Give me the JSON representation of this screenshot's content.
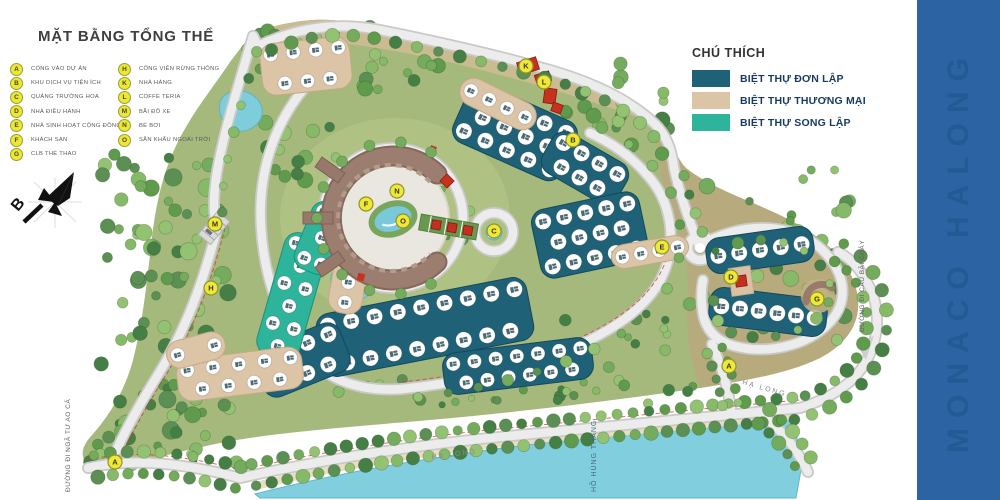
{
  "title": "MẶT BẰNG TỔNG THỂ",
  "brand": {
    "text": "MONACO HALONG",
    "bg_color": "#2b63a3"
  },
  "compass": {
    "north_label": "B"
  },
  "amenities_legend": {
    "columns": [
      [
        {
          "key": "A",
          "label": "CỔNG VÀO DỰ ÁN"
        },
        {
          "key": "B",
          "label": "KHU DỊCH VỤ TIỆN ÍCH"
        },
        {
          "key": "C",
          "label": "QUẢNG TRƯỜNG HOA"
        },
        {
          "key": "D",
          "label": "NHÀ ĐIỀU HÀNH"
        },
        {
          "key": "E",
          "label": "NHÀ SINH HOẠT CỘNG ĐỒNG"
        },
        {
          "key": "F",
          "label": "KHÁCH SẠN"
        },
        {
          "key": "G",
          "label": "CLB THỂ THAO"
        }
      ],
      [
        {
          "key": "H",
          "label": "CÔNG VIÊN RỪNG THÔNG"
        },
        {
          "key": "K",
          "label": "NHÀ HÀNG"
        },
        {
          "key": "L",
          "label": "COFFE TERIA"
        },
        {
          "key": "M",
          "label": "BÃI ĐỖ XE"
        },
        {
          "key": "N",
          "label": "BỂ BƠI"
        },
        {
          "key": "O",
          "label": "SÂN KHẤU NGOÀI TRỜI"
        }
      ]
    ]
  },
  "type_legend": {
    "title": "CHÚ THÍCH",
    "items": [
      {
        "label": "BIỆT THỰ ĐƠN LẬP",
        "color": "#1f6278"
      },
      {
        "label": "BIỆT THỰ THƯƠNG MẠI",
        "color": "#dcc4a6"
      },
      {
        "label": "BIỆT THỰ SONG LẬP",
        "color": "#2db49a"
      }
    ]
  },
  "map_labels": {
    "coast_road": "HẠ LONG",
    "coast_road_2": "HẠ LONG",
    "road_west": "ĐƯỜNG ĐI NGÃ TƯ AO CÁ",
    "road_east": "ĐƯỜNG ĐI CẦU BÃI CHÁY",
    "lake": "HỒ HÙNG THẮNG"
  },
  "markers": [
    {
      "letter": "A",
      "x": 115,
      "y": 462
    },
    {
      "letter": "A",
      "x": 729,
      "y": 366
    },
    {
      "letter": "M",
      "x": 215,
      "y": 224
    },
    {
      "letter": "H",
      "x": 211,
      "y": 288
    },
    {
      "letter": "F",
      "x": 366,
      "y": 204
    },
    {
      "letter": "N",
      "x": 397,
      "y": 191
    },
    {
      "letter": "O",
      "x": 403,
      "y": 221
    },
    {
      "letter": "C",
      "x": 494,
      "y": 231
    },
    {
      "letter": "K",
      "x": 526,
      "y": 66
    },
    {
      "letter": "L",
      "x": 544,
      "y": 82
    },
    {
      "letter": "B",
      "x": 573,
      "y": 140
    },
    {
      "letter": "E",
      "x": 662,
      "y": 247
    },
    {
      "letter": "D",
      "x": 731,
      "y": 277
    },
    {
      "letter": "G",
      "x": 817,
      "y": 299
    }
  ],
  "marker_style": {
    "fill": "#efe73a",
    "border": "#8f9426",
    "text_color": "#333a06"
  }
}
